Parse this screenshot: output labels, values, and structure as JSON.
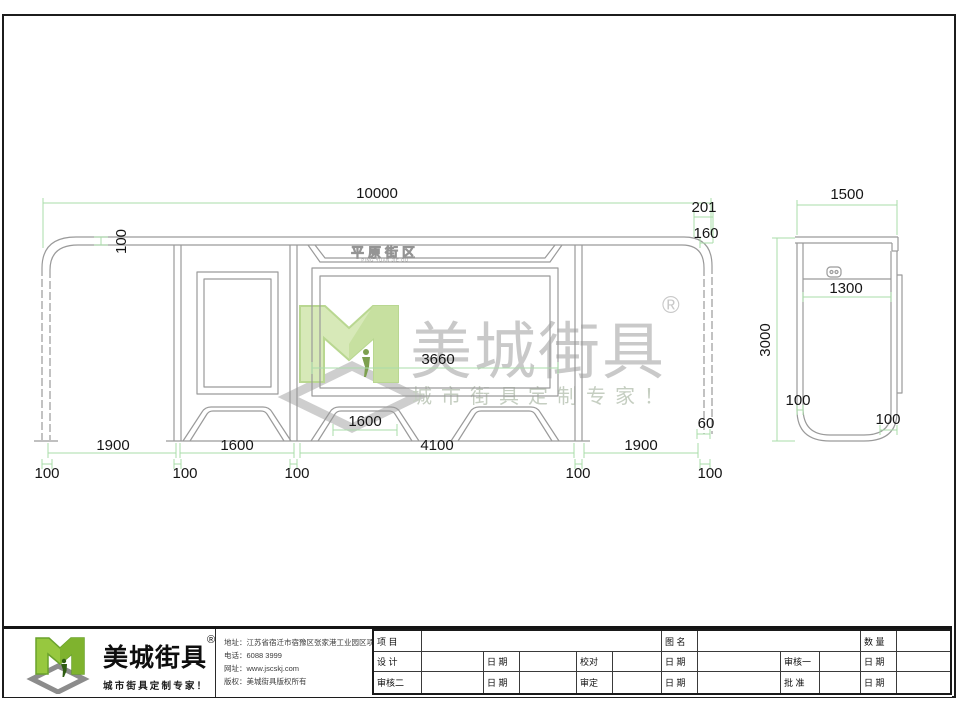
{
  "watermark": {
    "brand": "美城街具",
    "registered": "®",
    "slogan": "城市街具定制专家！"
  },
  "front_view": {
    "sign_title": "平原街区",
    "sign_subtitle": "PING YUAN JIE QU",
    "dim_total_width": "10000",
    "dim_roof_thickness": "100",
    "dim_right_overhang": "201",
    "dim_roof_edge": "160",
    "dim_ad_width": "3660",
    "dim_bench_width": "1600",
    "dim_right_leg": "60",
    "dim_bay_left": "1900",
    "dim_bay_panel": "1600",
    "dim_bay_center": "4100",
    "dim_bay_right": "1900",
    "dim_post_1": "100",
    "dim_post_2": "100",
    "dim_post_3": "100",
    "dim_post_4": "100",
    "dim_post_5": "100"
  },
  "side_view": {
    "dim_width": "1500",
    "dim_height": "3000",
    "dim_inner": "1300",
    "dim_post": "100",
    "dim_base": "100"
  },
  "title_block": {
    "brand": "美城街具",
    "registered": "®",
    "slogan": "城市街具定制专家！",
    "contact": {
      "address_label": "地址：",
      "address": "江苏省宿迁市宿豫区张家港工业园区项王路南侧1号",
      "phone_label": "电话：",
      "phone": "6088 3999",
      "web_label": "网址：",
      "web": "www.jscskj.com",
      "copyright_label": "版权：",
      "copyright": "美城街具版权所有"
    },
    "table": {
      "project": "项 目",
      "drawing_name": "图 名",
      "quantity": "数 量",
      "design": "设 计",
      "date": "日 期",
      "proofread": "校对",
      "review1": "审核一",
      "review2": "审核二",
      "approve_check": "审定",
      "approve": "批 准"
    }
  }
}
